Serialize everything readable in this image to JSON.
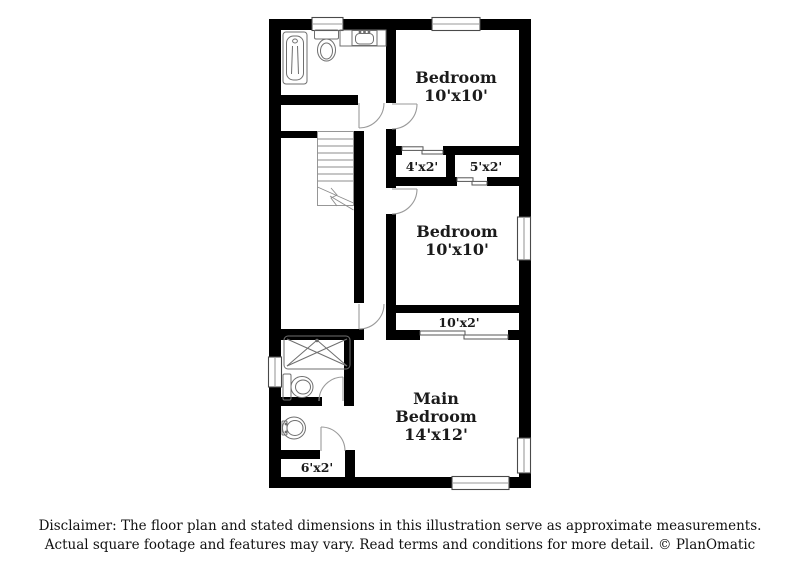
{
  "floor_plan": {
    "rooms": [
      {
        "id": "bedroom-top",
        "lines": [
          "Bedroom",
          "10'x10'"
        ]
      },
      {
        "id": "bedroom-middle",
        "lines": [
          "Bedroom",
          "10'x10'"
        ]
      },
      {
        "id": "main-bedroom",
        "lines": [
          "Main",
          "Bedroom",
          "14'x12'"
        ]
      }
    ],
    "closets": [
      {
        "id": "closet-top-left",
        "label": "4'x2'"
      },
      {
        "id": "closet-top-right",
        "label": "5'x2'"
      },
      {
        "id": "closet-middle",
        "label": "10'x2'"
      },
      {
        "id": "closet-bottom",
        "label": "6'x2'"
      }
    ],
    "fixtures": [
      "bathtub",
      "toilet",
      "vanity-sink",
      "staircase",
      "shower",
      "toilet",
      "pedestal-sink"
    ],
    "colors": {
      "wall": "#000000",
      "fixture_line": "#6f6f6f",
      "door_line": "#9a9a9a",
      "text": "#1b1b1b",
      "background": "#ffffff"
    }
  },
  "disclaimer": {
    "line1": "Disclaimer: The floor plan and stated dimensions in this illustration serve as approximate measurements.",
    "line2": "Actual square footage and features may vary. Read terms and conditions for more detail. © PlanOmatic"
  }
}
